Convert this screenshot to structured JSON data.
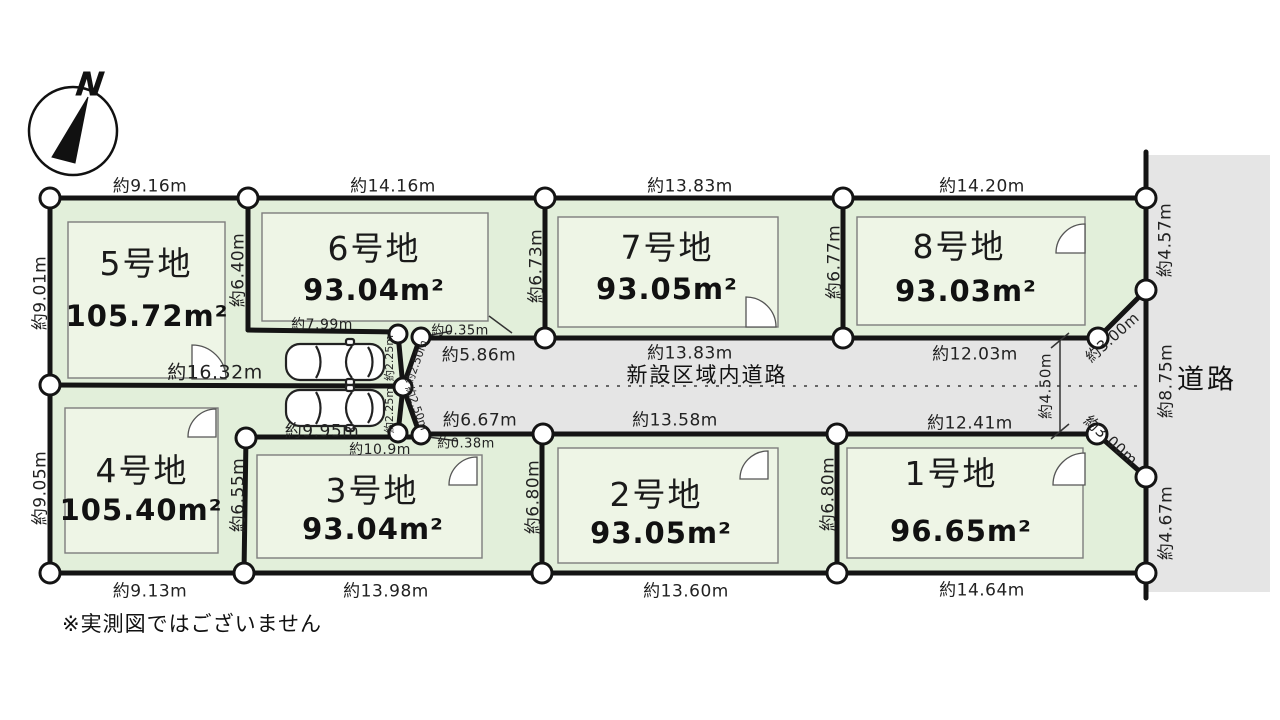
{
  "compass": {
    "label": "N"
  },
  "note": "※実測図ではございません",
  "roads": {
    "inner": "新設区域内道路",
    "right": "道路"
  },
  "lots": [
    {
      "name": "1号地",
      "area": "96.65m²"
    },
    {
      "name": "2号地",
      "area": "93.05m²"
    },
    {
      "name": "3号地",
      "area": "93.04m²"
    },
    {
      "name": "4号地",
      "area": "105.40m²"
    },
    {
      "name": "5号地",
      "area": "105.72m²"
    },
    {
      "name": "6号地",
      "area": "93.04m²"
    },
    {
      "name": "7号地",
      "area": "93.05m²"
    },
    {
      "name": "8号地",
      "area": "93.03m²"
    }
  ],
  "dimensions": {
    "top_5": "約9.16m",
    "top_6": "約14.16m",
    "top_7": "約13.83m",
    "top_8": "約14.20m",
    "left_5": "約9.01m",
    "left_4": "約9.05m",
    "side_5_6": "約6.40m",
    "side_6_7": "約6.73m",
    "side_7_8": "約6.77m",
    "right_upper": "約4.57m",
    "right_mid": "約8.75m",
    "right_lower": "約4.67m",
    "lot6_south": "約7.99m",
    "jog_top": "約0.35m",
    "line_1632": "約16.32m",
    "line_995": "約9.95m",
    "lot3_north": "約10.9m",
    "jog_bottom": "約0.38m",
    "funnel_225_a": "約2.25m",
    "funnel_225_b": "約2.25m",
    "funnel_250_a": "約2.50m",
    "funnel_250_b": "約2.50m",
    "road_top_w": "約5.86m",
    "road_top_7": "約13.83m",
    "road_top_8": "約12.03m",
    "road_bottom_w": "約6.67m",
    "road_bottom_2": "約13.58m",
    "road_bottom_1": "約12.41m",
    "road_width": "約4.50m",
    "cut_8": "約3.00m",
    "cut_1": "約3.00m",
    "bottom_4": "約9.13m",
    "bottom_3": "約13.98m",
    "bottom_2": "約13.60m",
    "bottom_1": "約14.64m"
  }
}
